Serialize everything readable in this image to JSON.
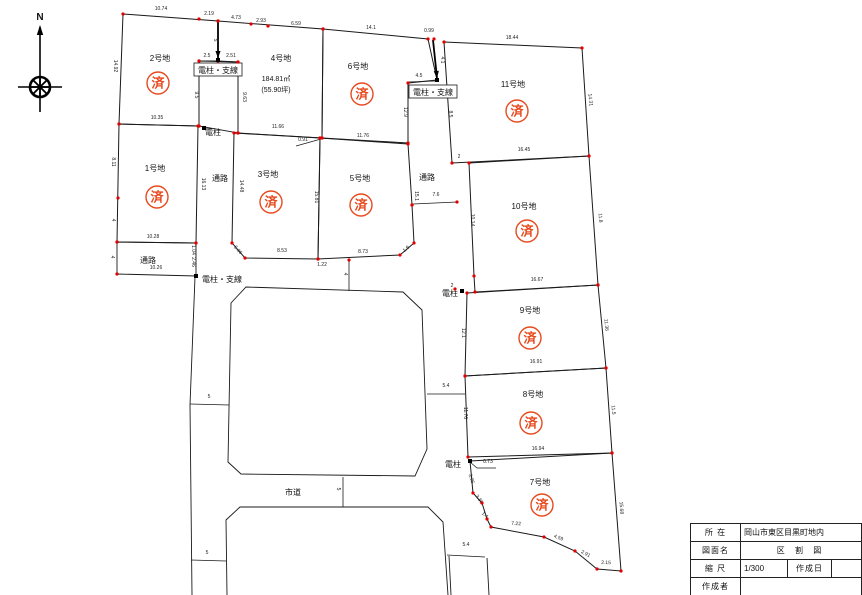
{
  "stamp_char": "済",
  "colors": {
    "line": "#1a1a1a",
    "dot": "#e00000",
    "stamp": "#e8491d",
    "dim": "#222222"
  },
  "compass": {
    "label": "N"
  },
  "title_block": {
    "loc_label": "所 在",
    "loc_value": "岡山市東区目黒町地内",
    "name_label": "図面名",
    "name_value": "区 割 図",
    "scale_label": "縮 尺",
    "scale_value": "1/300",
    "date_label": "作成日",
    "date_value": "",
    "author_label": "作成者",
    "author_value": ""
  },
  "map": {
    "plots": [
      {
        "id": "plot-1",
        "label": "1号地",
        "label_pos": [
          155,
          171
        ],
        "stamp_pos": [
          157,
          197
        ],
        "points": [
          [
            119,
            124
          ],
          [
            198,
            126
          ],
          [
            196,
            243
          ],
          [
            117,
            242
          ]
        ]
      },
      {
        "id": "plot-2",
        "label": "2号地",
        "label_pos": [
          160,
          61
        ],
        "stamp_pos": [
          158,
          83
        ],
        "points": [
          [
            123,
            14
          ],
          [
            218,
            21
          ],
          [
            218,
            61
          ],
          [
            199,
            61
          ],
          [
            199,
            126
          ],
          [
            119,
            124
          ]
        ]
      },
      {
        "id": "plot-3",
        "label": "3号地",
        "label_pos": [
          268,
          177
        ],
        "stamp_pos": [
          271,
          202
        ],
        "points": [
          [
            234,
            133
          ],
          [
            320,
            138
          ],
          [
            318,
            259
          ],
          [
            245,
            258
          ],
          [
            232,
            243
          ]
        ]
      },
      {
        "id": "plot-4",
        "label": "4号地",
        "label_pos": [
          281,
          61
        ],
        "stamp_pos": null,
        "area": [
          "184.81㎡",
          "(55.90坪)"
        ],
        "area_pos": [
          276,
          81
        ],
        "points": [
          [
            218,
            21
          ],
          [
            323,
            29
          ],
          [
            322,
            138
          ],
          [
            238,
            133
          ],
          [
            238,
            62
          ],
          [
            218,
            61
          ]
        ]
      },
      {
        "id": "plot-5",
        "label": "5号地",
        "label_pos": [
          360,
          181
        ],
        "stamp_pos": [
          361,
          205
        ],
        "points": [
          [
            320,
            138
          ],
          [
            408,
            144
          ],
          [
            412,
            205
          ],
          [
            414,
            243
          ],
          [
            400,
            255
          ],
          [
            318,
            259
          ]
        ]
      },
      {
        "id": "plot-6",
        "label": "6号地",
        "label_pos": [
          358,
          69
        ],
        "stamp_pos": [
          362,
          94
        ],
        "points": [
          [
            323,
            29
          ],
          [
            428,
            39
          ],
          [
            437,
            80
          ],
          [
            408,
            83
          ],
          [
            408,
            143
          ],
          [
            322,
            138
          ]
        ]
      },
      {
        "id": "plot-7",
        "label": "7号地",
        "label_pos": [
          540,
          485
        ],
        "stamp_pos": [
          542,
          505
        ],
        "points": [
          [
            470,
            461
          ],
          [
            612,
            453
          ],
          [
            621,
            571
          ],
          [
            597,
            569
          ],
          [
            575,
            551
          ],
          [
            544,
            537
          ],
          [
            491,
            527
          ],
          [
            487,
            519
          ],
          [
            482,
            503
          ],
          [
            473,
            493
          ]
        ]
      },
      {
        "id": "plot-8",
        "label": "8号地",
        "label_pos": [
          533,
          397
        ],
        "stamp_pos": [
          531,
          423
        ],
        "points": [
          [
            465,
            376
          ],
          [
            606,
            368
          ],
          [
            612,
            453
          ],
          [
            468,
            457
          ]
        ]
      },
      {
        "id": "plot-9",
        "label": "9号地",
        "label_pos": [
          530,
          313
        ],
        "stamp_pos": [
          530,
          338
        ],
        "points": [
          [
            467,
            293
          ],
          [
            598,
            285
          ],
          [
            606,
            368
          ],
          [
            465,
            376
          ]
        ]
      },
      {
        "id": "plot-10",
        "label": "10号地",
        "label_pos": [
          524,
          209
        ],
        "stamp_pos": [
          527,
          231
        ],
        "points": [
          [
            469,
            163
          ],
          [
            589,
            156
          ],
          [
            598,
            285
          ],
          [
            475,
            292
          ],
          [
            474,
            276
          ]
        ]
      },
      {
        "id": "plot-11",
        "label": "11号地",
        "label_pos": [
          513,
          87
        ],
        "stamp_pos": [
          517,
          111
        ],
        "points": [
          [
            444,
            42
          ],
          [
            582,
            48
          ],
          [
            589,
            156
          ],
          [
            452,
            163
          ]
        ]
      }
    ],
    "outlines": [
      {
        "id": "pole-strip",
        "closed": true,
        "dots": true,
        "points": [
          [
            199,
            61
          ],
          [
            238,
            62
          ],
          [
            238,
            133
          ],
          [
            199,
            126
          ]
        ]
      },
      {
        "id": "passage-west",
        "closed": true,
        "dots": true,
        "points": [
          [
            117,
            242
          ],
          [
            196,
            243
          ],
          [
            196,
            276
          ],
          [
            117,
            274
          ]
        ]
      },
      {
        "id": "block-upper",
        "closed": true,
        "dots": false,
        "points": [
          [
            231,
            303
          ],
          [
            246,
            287
          ],
          [
            403,
            292
          ],
          [
            422,
            310
          ],
          [
            427,
            449
          ],
          [
            415,
            476
          ],
          [
            241,
            474
          ],
          [
            228,
            462
          ]
        ]
      },
      {
        "id": "block-lower",
        "closed": false,
        "dots": false,
        "points": [
          [
            227,
            595
          ],
          [
            226,
            520
          ],
          [
            240,
            507
          ],
          [
            428,
            507
          ],
          [
            443,
            522
          ],
          [
            448,
            595
          ]
        ]
      },
      {
        "id": "road-left-west-edge",
        "closed": false,
        "dots": false,
        "points": [
          [
            195,
            277
          ],
          [
            190,
            405
          ],
          [
            192,
            595
          ]
        ]
      },
      {
        "id": "road-south-west-edge",
        "closed": false,
        "dots": false,
        "points": [
          [
            449,
            556
          ],
          [
            451,
            595
          ]
        ]
      },
      {
        "id": "road-south-east-edge",
        "closed": false,
        "dots": false,
        "points": [
          [
            487,
            558
          ],
          [
            489,
            595
          ]
        ]
      }
    ],
    "ticks": [
      [
        190,
        404,
        229,
        405
      ],
      [
        191,
        560,
        226,
        561
      ],
      [
        343,
        477,
        343,
        507
      ],
      [
        427,
        394,
        465,
        394
      ],
      [
        447,
        555,
        485,
        557
      ],
      [
        349,
        260,
        349,
        291
      ],
      [
        413,
        204,
        457,
        202
      ],
      [
        408,
        82,
        435,
        81
      ]
    ],
    "leaders": [
      [
        [
          321,
          139
        ],
        [
          296,
          146
        ]
      ],
      [
        [
          470,
          462
        ],
        [
          477,
          468
        ],
        [
          496,
          468
        ]
      ]
    ],
    "wires": [
      [
        218,
        22,
        218,
        58
      ],
      [
        433,
        40,
        437,
        78
      ]
    ],
    "poles": [
      [
        218,
        60
      ],
      [
        204,
        128
      ],
      [
        437,
        80
      ],
      [
        462,
        291
      ],
      [
        470,
        461
      ],
      [
        196,
        276
      ]
    ],
    "extra_dots": [
      [
        199,
        19
      ],
      [
        251,
        24
      ],
      [
        268,
        26
      ],
      [
        434,
        39
      ],
      [
        118,
        198
      ],
      [
        412,
        205
      ],
      [
        457,
        202
      ],
      [
        349,
        260
      ],
      [
        455,
        289
      ]
    ],
    "annotations": [
      {
        "t": "通路",
        "x": 220,
        "y": 178,
        "fs": 8
      },
      {
        "t": "通路",
        "x": 148,
        "y": 260,
        "fs": 8
      },
      {
        "t": "通路",
        "x": 427,
        "y": 177,
        "fs": 8
      },
      {
        "t": "市道",
        "x": 293,
        "y": 492,
        "fs": 8
      },
      {
        "t": "電柱・支線",
        "x": 218,
        "y": 70,
        "fs": 8,
        "boxed": true
      },
      {
        "t": "電柱・支線",
        "x": 433,
        "y": 92,
        "fs": 8,
        "boxed": true
      },
      {
        "t": "電柱・支線",
        "x": 222,
        "y": 279,
        "fs": 8
      },
      {
        "t": "電柱",
        "x": 213,
        "y": 132,
        "fs": 8
      },
      {
        "t": "電柱",
        "x": 450,
        "y": 293,
        "fs": 8
      },
      {
        "t": "電柱",
        "x": 453,
        "y": 464,
        "fs": 8
      }
    ],
    "dims": [
      {
        "t": "10.74",
        "x": 161,
        "y": 10
      },
      {
        "t": "2.19",
        "x": 209,
        "y": 15
      },
      {
        "t": "4.73",
        "x": 236,
        "y": 19
      },
      {
        "t": "2.93",
        "x": 261,
        "y": 22
      },
      {
        "t": "6.59",
        "x": 296,
        "y": 25
      },
      {
        "t": "14.1",
        "x": 371,
        "y": 29
      },
      {
        "t": "0.99",
        "x": 429,
        "y": 32
      },
      {
        "t": "18.44",
        "x": 512,
        "y": 39
      },
      {
        "t": "5",
        "x": 214,
        "y": 40,
        "r": 90
      },
      {
        "t": "4.1",
        "x": 441,
        "y": 60,
        "r": 90
      },
      {
        "t": "4.5",
        "x": 419,
        "y": 77
      },
      {
        "t": "2.5",
        "x": 207,
        "y": 57
      },
      {
        "t": "2.51",
        "x": 231,
        "y": 57
      },
      {
        "t": "9.5",
        "x": 195,
        "y": 95,
        "r": 90
      },
      {
        "t": "9.63",
        "x": 243,
        "y": 97,
        "r": 90
      },
      {
        "t": "14.92",
        "x": 114,
        "y": 66,
        "r": 90
      },
      {
        "t": "8.11",
        "x": 112,
        "y": 162,
        "r": 90
      },
      {
        "t": "4",
        "x": 112,
        "y": 220,
        "r": 90
      },
      {
        "t": "4",
        "x": 111,
        "y": 257,
        "r": 90
      },
      {
        "t": "10.35",
        "x": 157,
        "y": 119
      },
      {
        "t": "11.66",
        "x": 278,
        "y": 128
      },
      {
        "t": "0.91",
        "x": 303,
        "y": 141
      },
      {
        "t": "11.76",
        "x": 363,
        "y": 137
      },
      {
        "t": "16.13",
        "x": 202,
        "y": 184,
        "r": 90
      },
      {
        "t": "14.48",
        "x": 240,
        "y": 186,
        "r": 90
      },
      {
        "t": "15.81",
        "x": 315,
        "y": 197,
        "r": 90
      },
      {
        "t": "15.1",
        "x": 415,
        "y": 196,
        "r": 90
      },
      {
        "t": "12.9",
        "x": 404,
        "y": 112,
        "r": 90
      },
      {
        "t": "5.06",
        "x": 237,
        "y": 251,
        "r": 48
      },
      {
        "t": "8.53",
        "x": 282,
        "y": 252
      },
      {
        "t": "1.22",
        "x": 322,
        "y": 266
      },
      {
        "t": "8.73",
        "x": 363,
        "y": 253
      },
      {
        "t": "1.9",
        "x": 407,
        "y": 250,
        "r": -40
      },
      {
        "t": "7.6",
        "x": 436,
        "y": 196
      },
      {
        "t": "8.5",
        "x": 449,
        "y": 114,
        "r": 90
      },
      {
        "t": "14.31",
        "x": 589,
        "y": 100,
        "r": 84
      },
      {
        "t": "16.45",
        "x": 524,
        "y": 151
      },
      {
        "t": "2",
        "x": 459,
        "y": 158
      },
      {
        "t": "10.14",
        "x": 471,
        "y": 220,
        "r": 90
      },
      {
        "t": "11.8",
        "x": 599,
        "y": 218,
        "r": 85
      },
      {
        "t": "16.67",
        "x": 537,
        "y": 281
      },
      {
        "t": "2",
        "x": 452,
        "y": 287
      },
      {
        "t": "12.1",
        "x": 462,
        "y": 333,
        "r": 90
      },
      {
        "t": "11.36",
        "x": 605,
        "y": 325,
        "r": 85
      },
      {
        "t": "16.91",
        "x": 536,
        "y": 363
      },
      {
        "t": "11.76",
        "x": 464,
        "y": 413,
        "r": 90
      },
      {
        "t": "11.5",
        "x": 612,
        "y": 410,
        "r": 85
      },
      {
        "t": "16.94",
        "x": 538,
        "y": 450
      },
      {
        "t": "3.96",
        "x": 470,
        "y": 479,
        "r": 72
      },
      {
        "t": "3.36",
        "x": 478,
        "y": 500,
        "r": 55
      },
      {
        "t": "1.4",
        "x": 484,
        "y": 516,
        "r": 40
      },
      {
        "t": "7.22",
        "x": 516,
        "y": 525,
        "r": 4
      },
      {
        "t": "4.59",
        "x": 558,
        "y": 539,
        "r": 22
      },
      {
        "t": "2.91",
        "x": 585,
        "y": 555,
        "r": 28
      },
      {
        "t": "2.15",
        "x": 606,
        "y": 564,
        "r": 2
      },
      {
        "t": "15.68",
        "x": 620,
        "y": 508,
        "r": 86
      },
      {
        "t": "0.73",
        "x": 488,
        "y": 463
      },
      {
        "t": "5",
        "x": 209,
        "y": 398
      },
      {
        "t": "5",
        "x": 207,
        "y": 554
      },
      {
        "t": "5",
        "x": 337,
        "y": 489,
        "r": 90
      },
      {
        "t": "5.4",
        "x": 446,
        "y": 387
      },
      {
        "t": "5.4",
        "x": 466,
        "y": 546
      },
      {
        "t": "4",
        "x": 344,
        "y": 274,
        "r": 90
      },
      {
        "t": "10.28",
        "x": 153,
        "y": 238
      },
      {
        "t": "10.26",
        "x": 156,
        "y": 269
      },
      {
        "t": "1.04",
        "x": 192,
        "y": 250,
        "r": 90
      },
      {
        "t": "2.46",
        "x": 192,
        "y": 262,
        "r": 90
      }
    ]
  }
}
